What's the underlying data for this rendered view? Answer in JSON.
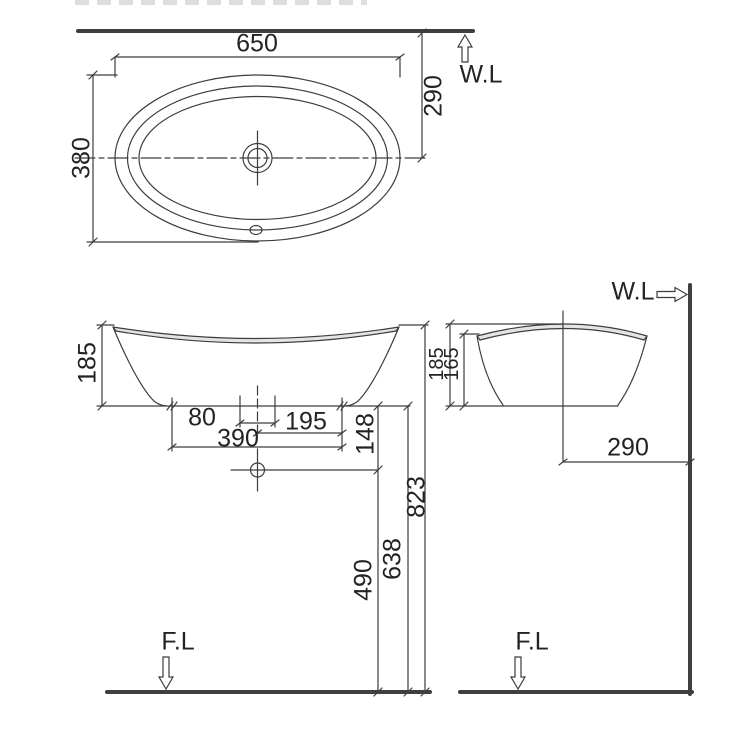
{
  "labels": {
    "water_line": "W.L",
    "floor_line": "F.L"
  },
  "plan_view": {
    "overall_width": "650",
    "overall_depth": "380",
    "wall_to_centerline": "290"
  },
  "front_view": {
    "basin_height": "185",
    "faucet_hole_span": "80",
    "centerline_to_right_edge": "195",
    "base_width": "390",
    "base_to_drain": "148",
    "floor_to_rim": "823",
    "floor_to_base": "638",
    "floor_to_drain": "490"
  },
  "side_view": {
    "rim_height": "185",
    "front_edge_height": "165",
    "wall_to_centerline": "290"
  },
  "colors": {
    "line": "#3d3d3d",
    "heavy_line": "#3f3f3f",
    "text": "#232323"
  }
}
